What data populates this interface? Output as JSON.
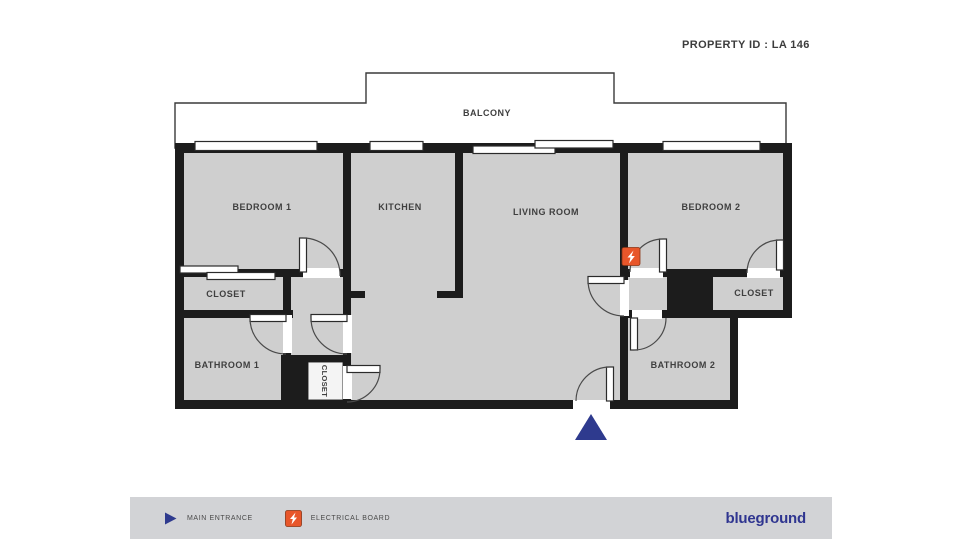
{
  "header": {
    "property_id": "PROPERTY ID : LA 146"
  },
  "plan": {
    "balcony": "BALCONY",
    "bedroom1": "BEDROOM 1",
    "kitchen": "KITCHEN",
    "living_room": "LIVING ROOM",
    "bedroom2": "BEDROOM 2",
    "closet1": "CLOSET",
    "bathroom1": "BATHROOM 1",
    "closet_hall": "CLOSET",
    "closet2": "CLOSET",
    "bathroom2": "BATHROOM 2"
  },
  "legend": {
    "main_entrance": "MAIN ENTRANCE",
    "electrical_board": "ELECTRICAL BOARD"
  },
  "brand": {
    "logo": "blueground"
  },
  "colors": {
    "room_fill": "#cfcfcf",
    "wall": "#1c1c1c",
    "navy": "#2e3a8e",
    "orange": "#e8562a",
    "legend_bar": "#d2d3d6",
    "logo_navy": "#2f3590"
  }
}
